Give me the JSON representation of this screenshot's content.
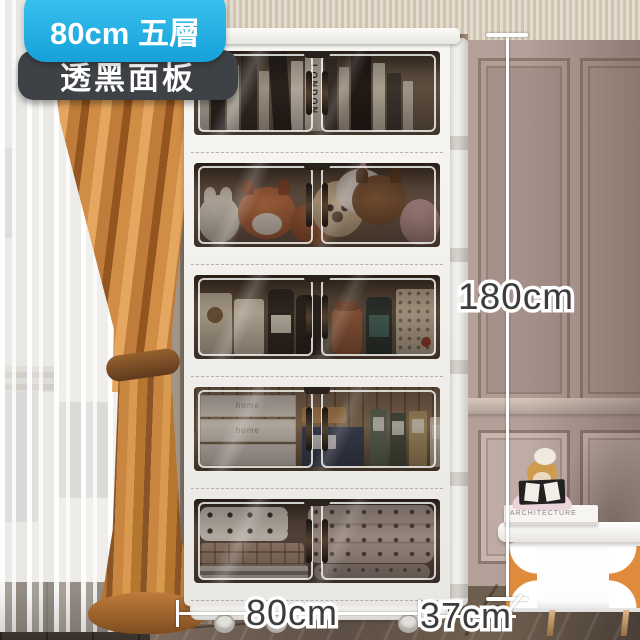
{
  "badges": {
    "size": "80cm 五層",
    "panel": "透黑面板"
  },
  "dimensions": {
    "height": "180cm",
    "width": "80cm",
    "depth": "37cm"
  },
  "cabinet": {
    "tier1_book_spine": "LONDON",
    "tier4_box_label": "home"
  },
  "nightstand": {
    "book_spine": "ARCHITECTURE"
  },
  "colors": {
    "badge_blue": "#29B4E8",
    "badge_dark": "#3E4145",
    "curtain_orange": "#C98240",
    "wall_mauve": "#A9948B",
    "cabinet_white": "#F3F2EF",
    "dimension_text": "#3C3C3C"
  }
}
